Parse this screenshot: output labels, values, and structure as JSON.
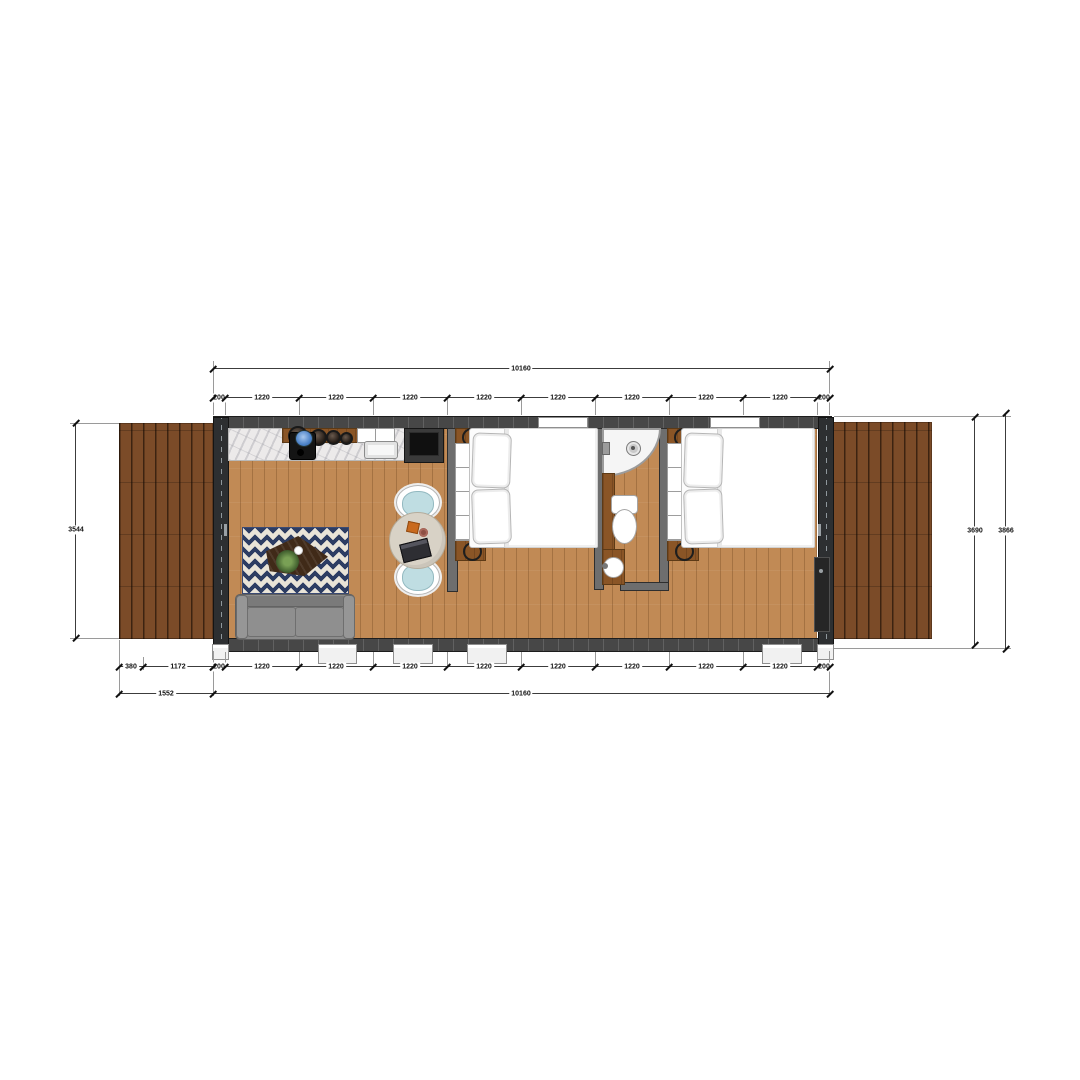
{
  "scene": "container-home-floor-plan",
  "dims": {
    "top_total": "10160",
    "top_segments": [
      "200",
      "1220",
      "1220",
      "1220",
      "1220",
      "1220",
      "1220",
      "1220",
      "1220",
      "200"
    ],
    "bottom_segments": [
      "200",
      "1220",
      "1220",
      "1220",
      "1220",
      "1220",
      "1220",
      "1220",
      "1220",
      "200"
    ],
    "deck_segments": [
      "380",
      "1172"
    ],
    "deck_total": "1552",
    "bottom_total": "10160",
    "left_depth": "3544",
    "right_depth_inner": "3690",
    "right_depth_outer": "3866"
  },
  "colors": {
    "floor_wood": "#c18a55",
    "deck_wood": "#7b4b28",
    "wall": "#474747",
    "rug_navy": "#2d3d63",
    "chair_seat": "#bfdde2",
    "marble_counter": "#eceaea",
    "cabinet_wood": "#8a5526",
    "sofa_gray": "#8c8c8c"
  }
}
